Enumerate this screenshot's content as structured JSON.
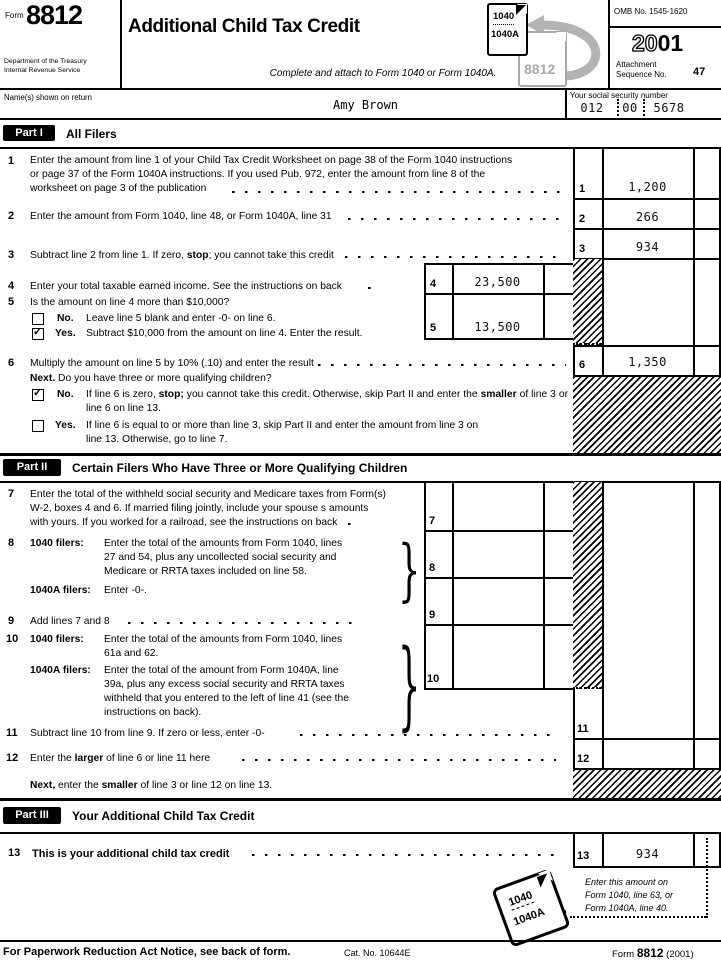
{
  "glyphs": {
    "check": "✓",
    "brace": "}"
  },
  "header": {
    "form_word": "Form",
    "form_number": "8812",
    "dept1": "Department of the Treasury",
    "dept2": "Internal Revenue Service",
    "title": "Additional Child Tax Credit",
    "subtitle": "Complete and attach to Form 1040 or Form 1040A.",
    "omb": "OMB No. 1545-1620",
    "year_o": "20",
    "year_s": "01",
    "att1": "Attachment",
    "att2": "Sequence No.",
    "att_no": "47",
    "icon_front_top": "1040",
    "icon_front_bottom": "1040A",
    "icon_back": "8812"
  },
  "name": {
    "label": "Name(s) shown on return",
    "value": "Amy Brown",
    "ssn_label": "Your social security number",
    "ssn1": "012",
    "ssn2": "00",
    "ssn3": "5678"
  },
  "p1": {
    "tab": "Part I",
    "heading": "All Filers",
    "l1_no": "1",
    "l1_text": "Enter the amount from line 1 of your Child Tax Credit Worksheet on page 38 of the Form 1040 instructions\nor page 37 of the Form 1040A instructions. If you used Pub. 972, enter the amount from line 8 of the\nworksheet on page 3 of the publication",
    "l2_no": "2",
    "l2_text": "Enter the amount from Form 1040, line 48, or Form 1040A, line 31",
    "l3_no": "3",
    "l3_pre": "Subtract line 2 from line 1. If zero, ",
    "l3_b": "stop",
    "l3_post": "; you cannot take this credit",
    "l4_no": "4",
    "l4_text": "Enter your total taxable earned income. See the instructions on back",
    "l5_no": "5",
    "l5_text": "Is the amount on line 4 more than $10,000?",
    "l5_no_label": "No.",
    "l5_no_text": "Leave line 5 blank and enter -0- on line 6.",
    "l5_yes_label": "Yes.",
    "l5_yes_text": "Subtract $10,000 from the amount on line 4. Enter the result.",
    "l6_no": "6",
    "l6_text": "Multiply the amount on line 5 by 10% (.10) and enter the result",
    "next_b": "Next.",
    "next_t": " Do you have three or more qualifying children?",
    "l6no_label": "No.",
    "l6no_pre": "If line 6 is zero, ",
    "l6no_b1": "stop;",
    "l6no_mid": " you cannot take this credit. Otherwise, skip Part II and enter the ",
    "l6no_b2": "smaller",
    "l6no_post": " of line 3 or line 6 on line 13.",
    "l6yes_label": "Yes.",
    "l6yes_text": "If line 6 is equal to or more than line 3, skip Part II and enter the amount from line 3 on\nline 13. Otherwise, go to line 7."
  },
  "p2": {
    "tab": "Part II",
    "heading": "Certain Filers Who Have Three or More Qualifying Children",
    "l7_no": "7",
    "l7_text": "Enter the total of the withheld social security and Medicare taxes from Form(s)\nW-2, boxes 4 and 6. If married filing jointly, include your spouse s amounts\nwith yours. If you worked for a railroad, see the instructions on back",
    "l8_no": "8",
    "f1040": "1040 filers:",
    "f1040a": "1040A filers:",
    "l8_1040": "Enter the total of the amounts from Form 1040, lines\n27 and 54, plus any uncollected social security and\nMedicare or RRTA taxes included on line 58.",
    "l8_1040a": "Enter -0-.",
    "l9_no": "9",
    "l9_text": "Add lines 7 and 8",
    "l10_no": "10",
    "l10_1040": "Enter the total of the amounts from Form 1040, lines\n61a and 62.",
    "l10_1040a": "Enter the total of the amount from Form 1040A, line\n39a, plus any excess social security and RRTA taxes\nwithheld that you entered to the left of line 41 (see the\ninstructions on back).",
    "l11_no": "11",
    "l11_text": "Subtract line 10 from line 9. If zero or less, enter -0-",
    "l12_no": "12",
    "l12_pre": "Enter the ",
    "l12_b": "larger",
    "l12_post": " of line 6 or line 11 here",
    "next_b": "Next,",
    "next_mid": " enter the ",
    "next_b2": "smaller",
    "next_post": " of line 3 or line 12 on line 13."
  },
  "p3": {
    "tab": "Part III",
    "heading": "Your Additional Child Tax Credit",
    "l13_no": "13",
    "l13_text": "This is your additional child tax credit",
    "note": "Enter this amount on\nForm 1040, line 63, or\nForm 1040A, line 40.",
    "doc_top": "1040",
    "doc_bottom": "1040A"
  },
  "amts": {
    "l1": "1,200",
    "l2": "266",
    "l3": "934",
    "l4": "23,500",
    "l5": "13,500",
    "l6": "1,350",
    "l13": "934"
  },
  "footer": {
    "notice": "For Paperwork Reduction Act Notice, see back of form.",
    "cat": "Cat. No. 10644E",
    "form_word": "Form",
    "form_number": "8812",
    "year": "(2001)"
  }
}
